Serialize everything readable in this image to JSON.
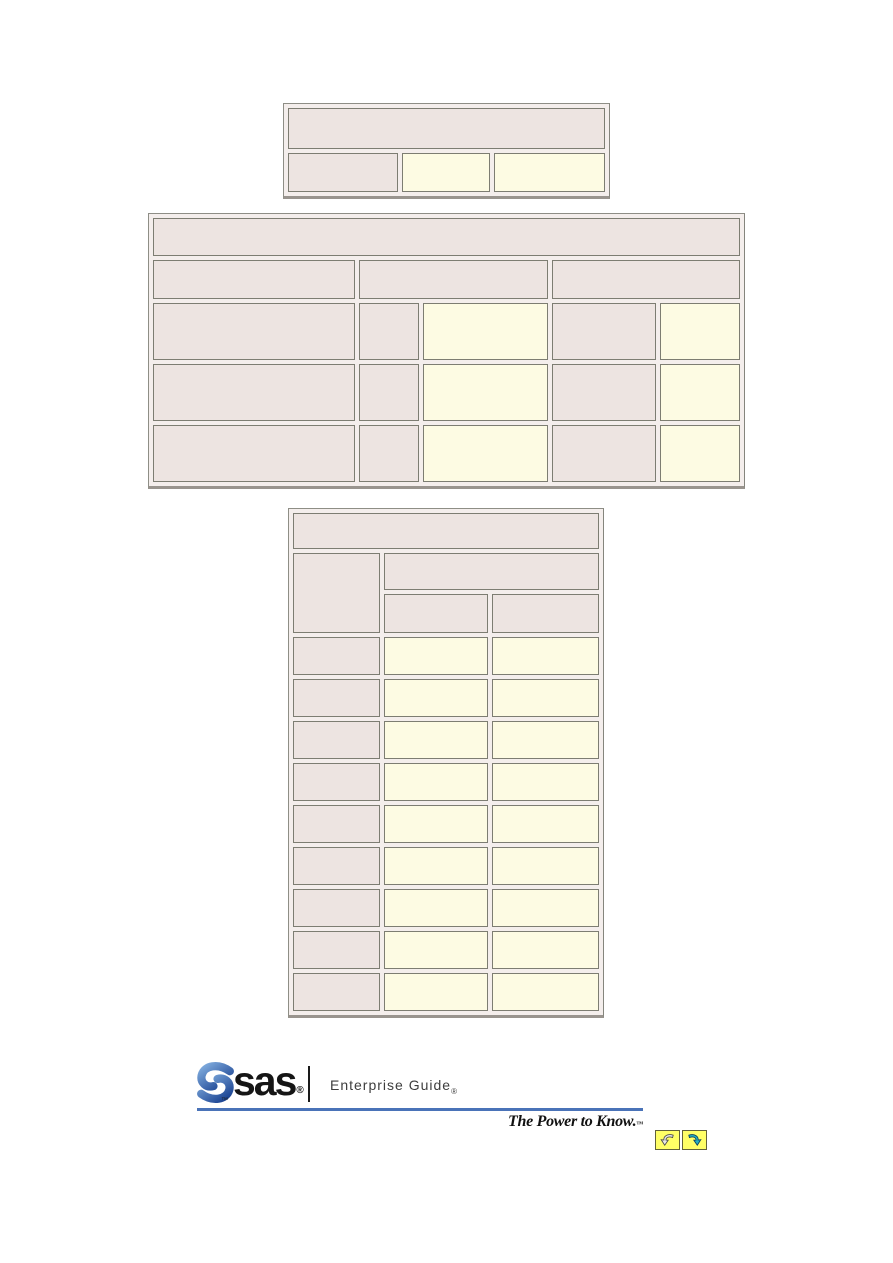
{
  "page": {
    "background": "#ffffff"
  },
  "colors": {
    "header_cell_bg": "#ede4e1",
    "data_cell_bg": "#fdfbe3",
    "cell_border": "#7d7d72",
    "table_frame_bg": "#f4eeec",
    "table_frame_border": "#8e8e86",
    "footer_rule_blue": "#4a73b8",
    "nav_button_yellow": "#ffff66",
    "sas_logo_blue_light": "#7fabdd",
    "sas_logo_blue_dark": "#173f8f",
    "next_arrow_teal": "#25b0c0"
  },
  "tables": {
    "top": {
      "header_row_count": 1,
      "body_row_count": 1,
      "column_count": 3
    },
    "middle": {
      "header_row_count": 2,
      "body_row_count": 3,
      "column_count": 5
    },
    "bottom": {
      "header_row_count": 3,
      "body_row_count": 9,
      "column_count": 3
    }
  },
  "footer": {
    "sas_wordmark": "sas",
    "sas_registered_mark": "®",
    "sas_trademark_mark": "™",
    "product_name": "Enterprise Guide",
    "product_registered_mark": "®",
    "tagline": "The Power to Know.",
    "tagline_trademark_mark": "™",
    "icons": {
      "previous": "curved-arrow-previous-icon",
      "next": "curved-arrow-next-icon"
    }
  }
}
